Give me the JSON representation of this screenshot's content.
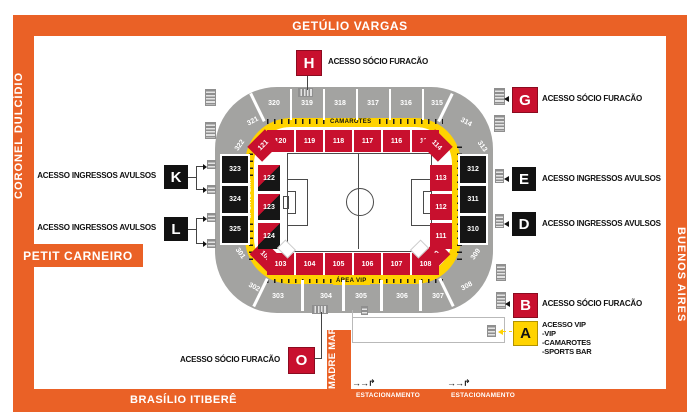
{
  "colors": {
    "orange": "#EA6126",
    "red": "#C8102E",
    "yellow": "#FFD300",
    "gray": "#A3A3A1",
    "black": "#151515"
  },
  "streets": {
    "top": "GETÚLIO VARGAS",
    "left": "CORONEL DULCÍDIO",
    "right": "BUENOS AIRES",
    "bottom": "BRASÍLIO ITIBERÊ",
    "petit_carneiro": "PETIT CARNEIRO",
    "madre_maria": "MADRE MARIA"
  },
  "parking": {
    "label": "ESTACIONAMENTO"
  },
  "legend_boxes": {
    "H": {
      "letter": "H",
      "text": "ACESSO SÓCIO FURACÃO"
    },
    "G": {
      "letter": "G",
      "text": "ACESSO SÓCIO FURACÃO"
    },
    "E": {
      "letter": "E",
      "text": "ACESSO INGRESSOS AVULSOS"
    },
    "D": {
      "letter": "D",
      "text": "ACESSO INGRESSOS AVULSOS"
    },
    "B": {
      "letter": "B",
      "text": "ACESSO SÓCIO FURACÃO"
    },
    "A": {
      "letter": "A",
      "lines": [
        "ACESSO VIP",
        "-VIP",
        "-CAMAROTES",
        "-SPORTS BAR"
      ]
    },
    "K": {
      "letter": "K",
      "text": "ACESSO INGRESSOS AVULSOS"
    },
    "L": {
      "letter": "L",
      "text": "ACESSO INGRESSOS AVULSOS"
    },
    "O": {
      "letter": "O",
      "text": "ACESSO SÓCIO FURACÃO"
    }
  },
  "stadium": {
    "bands": {
      "camarotes": "CAMAROTES",
      "area_vip": "ÁREA VIP",
      "sports_bar": "SPORTS BAR"
    },
    "outer": {
      "top": [
        "320",
        "319",
        "318",
        "317",
        "316",
        "315"
      ],
      "top_left": [
        "321",
        "322"
      ],
      "top_right": [
        "314",
        "313"
      ],
      "left": [
        "323",
        "324",
        "325"
      ],
      "right": [
        "312",
        "311",
        "310"
      ],
      "bottom_left": [
        "301",
        "302"
      ],
      "bottom_right": [
        "309",
        "308"
      ],
      "bottom": [
        "303",
        "304",
        "305",
        "306",
        "307"
      ]
    },
    "inner": {
      "top": [
        "120",
        "119",
        "118",
        "117",
        "116",
        "115"
      ],
      "corners": {
        "top_left": "121",
        "top_right": "114",
        "bottom_left": "101",
        "bottom_right": "110"
      },
      "left": [
        "122",
        "123",
        "124"
      ],
      "right": [
        "113",
        "112",
        "111"
      ],
      "bottom": [
        "103",
        "104",
        "105",
        "106",
        "107",
        "108"
      ]
    }
  }
}
